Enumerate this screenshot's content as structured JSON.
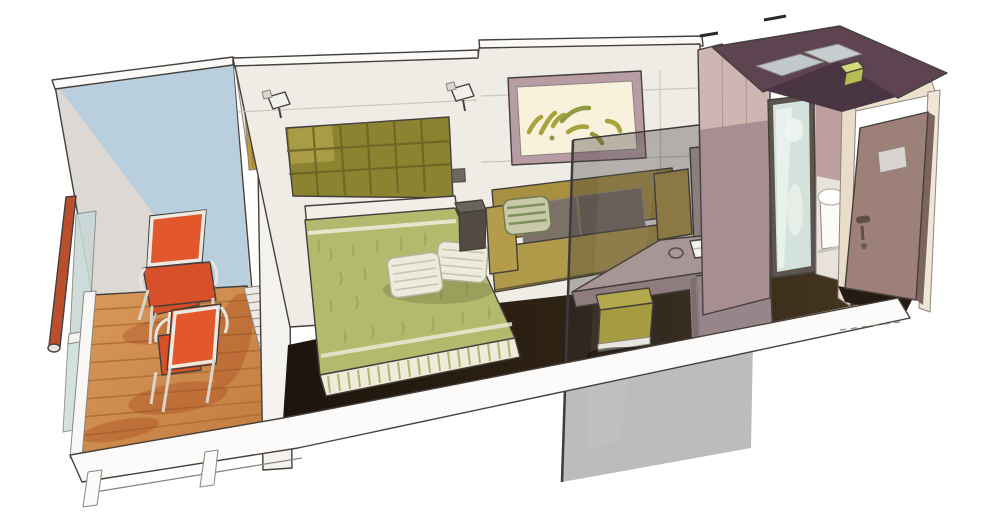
{
  "illustration": {
    "kind": "watercolor cutaway illustration of a ship cabin with balcony",
    "objects": [
      "balcony-railing",
      "balcony-glass-balustrade",
      "deck-chair-far",
      "deck-chair-near",
      "tray-table",
      "wooden-deck",
      "door-track-grate",
      "cut-partition-wall",
      "balcony-door-curtain",
      "tufted-headboard",
      "reading-sconce-left",
      "reading-sconce-right",
      "wall-switch",
      "bed",
      "bed-pillows",
      "bed-skirt",
      "nightstand",
      "wall-artwork",
      "sofa",
      "striped-throw-pillow",
      "smoked-glass-divider",
      "desk",
      "notepad",
      "stool",
      "wardrobe",
      "carpet",
      "bathroom-block",
      "glass-bathroom-door",
      "toilet",
      "cabin-entry-door",
      "door-placard",
      "door-handle",
      "ceiling-cutaway",
      "ceiling-light",
      "floor-slab"
    ]
  },
  "palette": {
    "balcony_blue": "#b9cfdd",
    "balcony_wall_grey": "#dcd8d3",
    "rail_red": "#bc4f2b",
    "deck_wood": "#cf8c4e",
    "chair_orange": "#e2572b",
    "partition_white": "#f4f2ef",
    "curtain_gold": "#c09a3e",
    "wall_cream": "#efece5",
    "headboard_olive": "#8b8330",
    "bedspread_green": "#b2ba6e",
    "pillow_cream": "#ecebdd",
    "carpet_dark": "#241a10",
    "sofa_mustard": "#b1994a",
    "art_frame_mauve": "#b89ca4",
    "art_mat_cream": "#f8f2dc",
    "desk_taupe": "#a89697",
    "stool_olive": "#b2a84c",
    "wardrobe_taupe": "#b4a6a2",
    "bathroom_mauve": "#d0b6b2",
    "ceiling_plum": "#5e4350",
    "door_mauve": "#9d8078",
    "glass_tint": "#d3e2dc"
  }
}
